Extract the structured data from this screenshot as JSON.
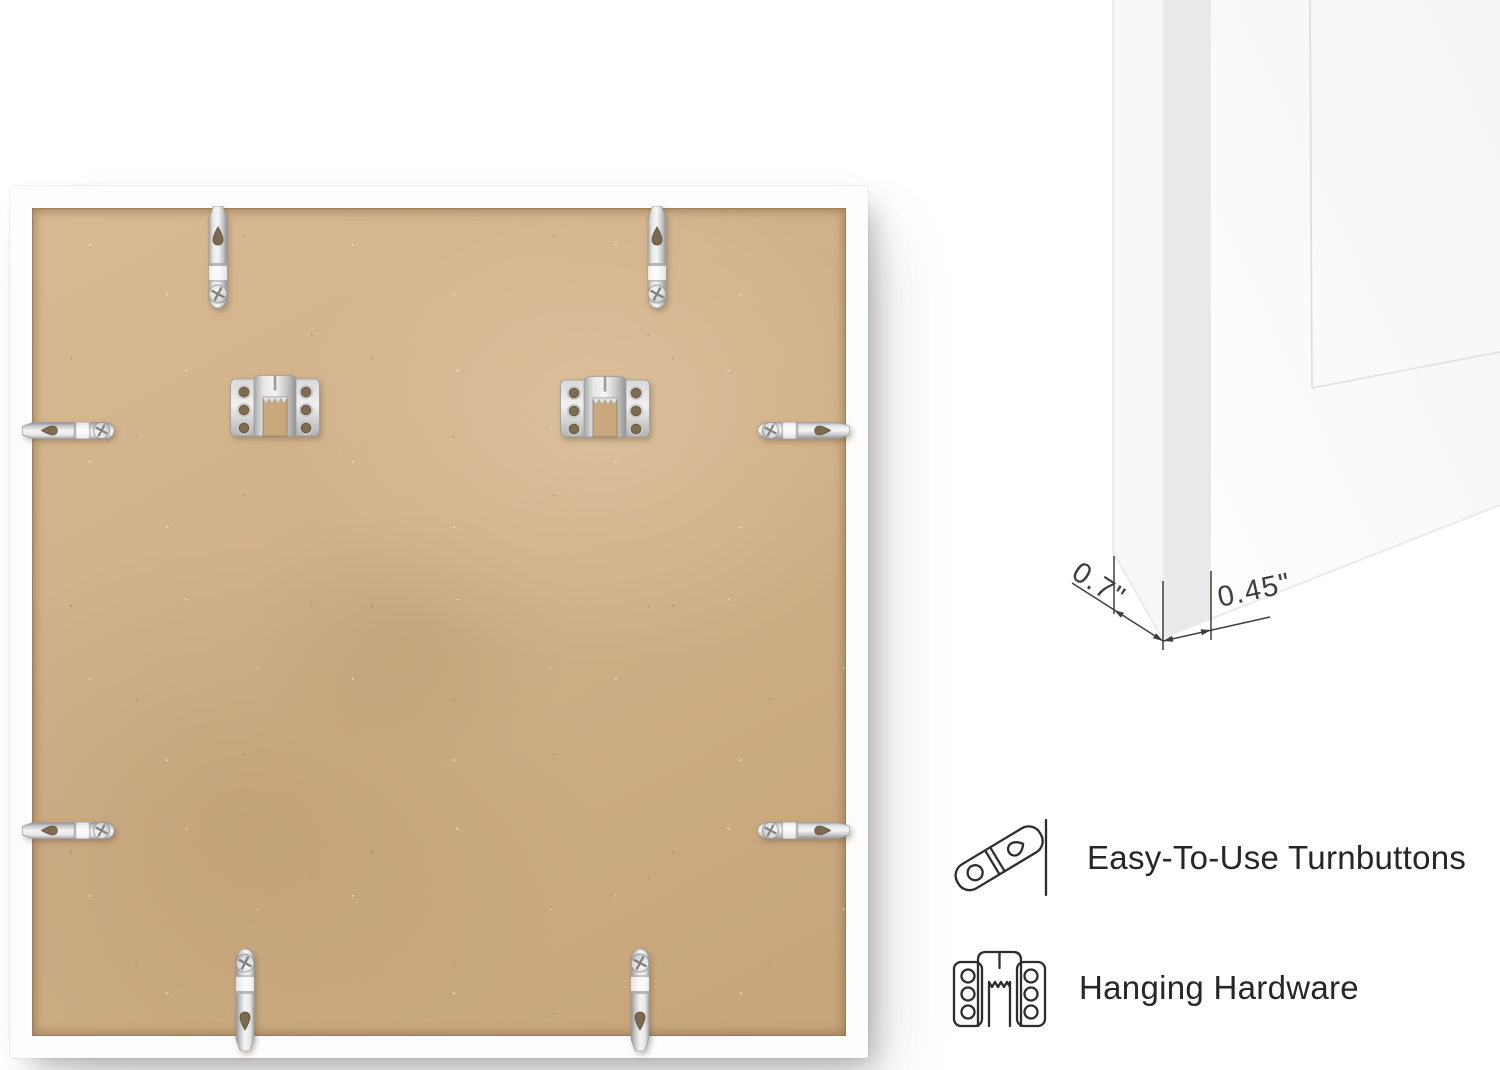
{
  "back_view": {
    "description": "back of square picture frame",
    "board_color": "#cfae84",
    "frame_color": "#ffffff",
    "turnbutton_count": 8,
    "sawtooth_hanger_count": 2
  },
  "corner_view": {
    "description": "white frame corner close-up",
    "dimensions": {
      "depth": "0.7\"",
      "face_width": "0.45\""
    }
  },
  "features": [
    {
      "icon": "turnbutton-icon",
      "label": "Easy-To-Use Turnbuttons"
    },
    {
      "icon": "sawtooth-hanger-icon",
      "label": "Hanging Hardware"
    }
  ],
  "colors": {
    "background": "#ffffff",
    "board": "#cfae84",
    "metal_highlight": "#f4f4f4",
    "metal_shadow": "#939393",
    "text": "#262626",
    "annotation_line": "#3f3f3f"
  }
}
